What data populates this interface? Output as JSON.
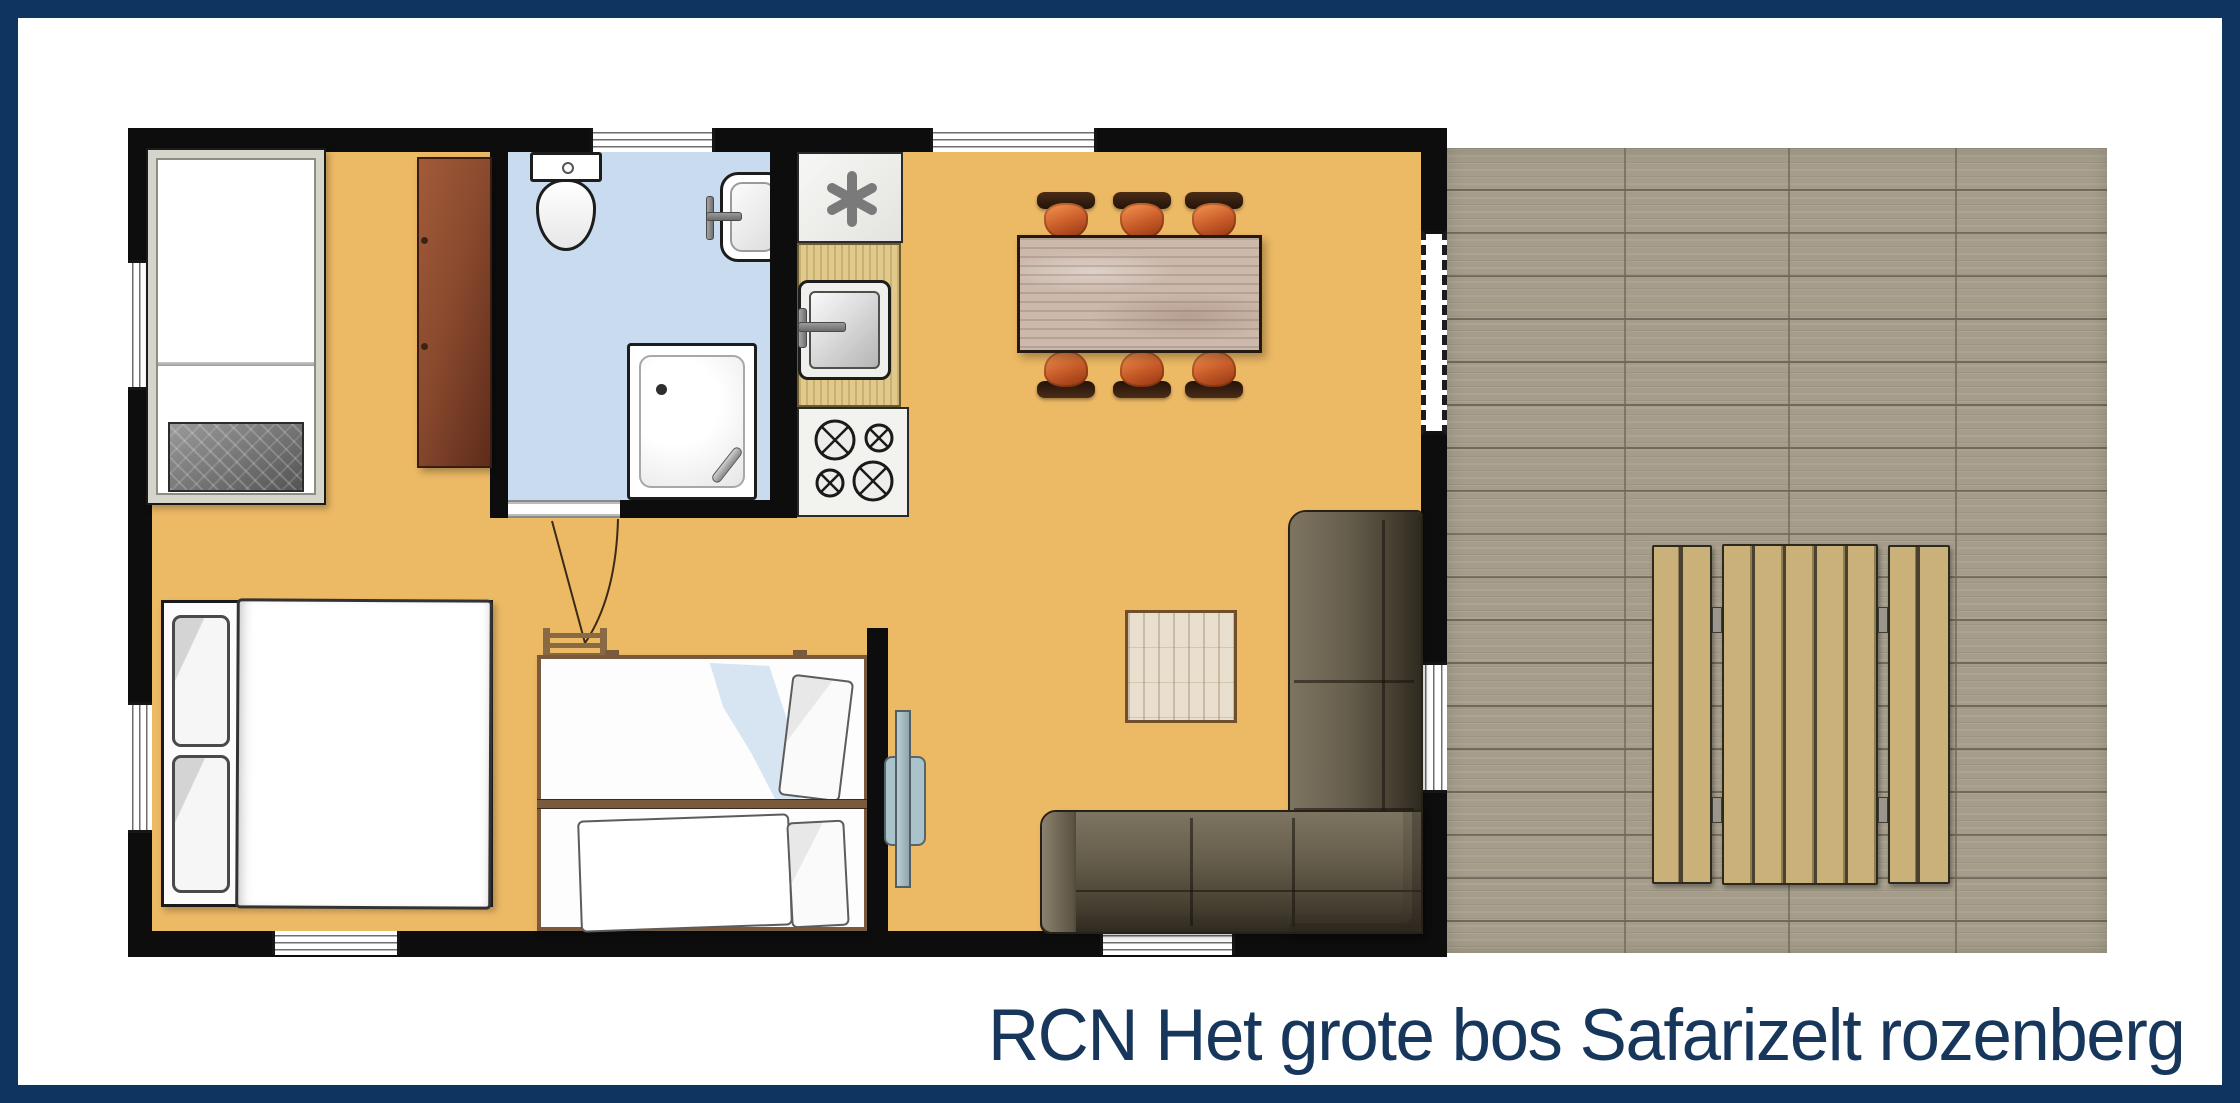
{
  "caption": {
    "text": "RCN Het grote bos Safarizelt rozenberg"
  },
  "palette": {
    "border_navy": "#0e3560",
    "caption_navy": "#16365c",
    "wall_black": "#0d0d0d",
    "floor_orange": "#ecb965",
    "bathroom_blue": "#c9dcef",
    "deck_taupe": "#a59d8a",
    "picnic_wood": "#c9b179",
    "counter_wood": "#e0c98b",
    "wardrobe_brown": "#8a4a2e",
    "dining_table_wood": "#ccb9ac",
    "chair_orange": "#c65a28",
    "sofa_taupe": "#5e5747",
    "rug_cream": "#e9dfcf"
  },
  "icons": [
    "single-bed-icon",
    "double-bed-icon",
    "bunk-bed-icon",
    "ladder-icon",
    "wardrobe-icon",
    "toilet-icon",
    "washbasin-icon",
    "shower-icon",
    "water-heater-icon",
    "kitchen-sink-icon",
    "stove-icon",
    "dining-table-icon",
    "dining-chair-icon",
    "sofa-icon",
    "rug-icon",
    "wall-mirror-icon",
    "picnic-table-icon",
    "picnic-bench-icon",
    "window-icon",
    "door-icon",
    "deck-icon"
  ]
}
